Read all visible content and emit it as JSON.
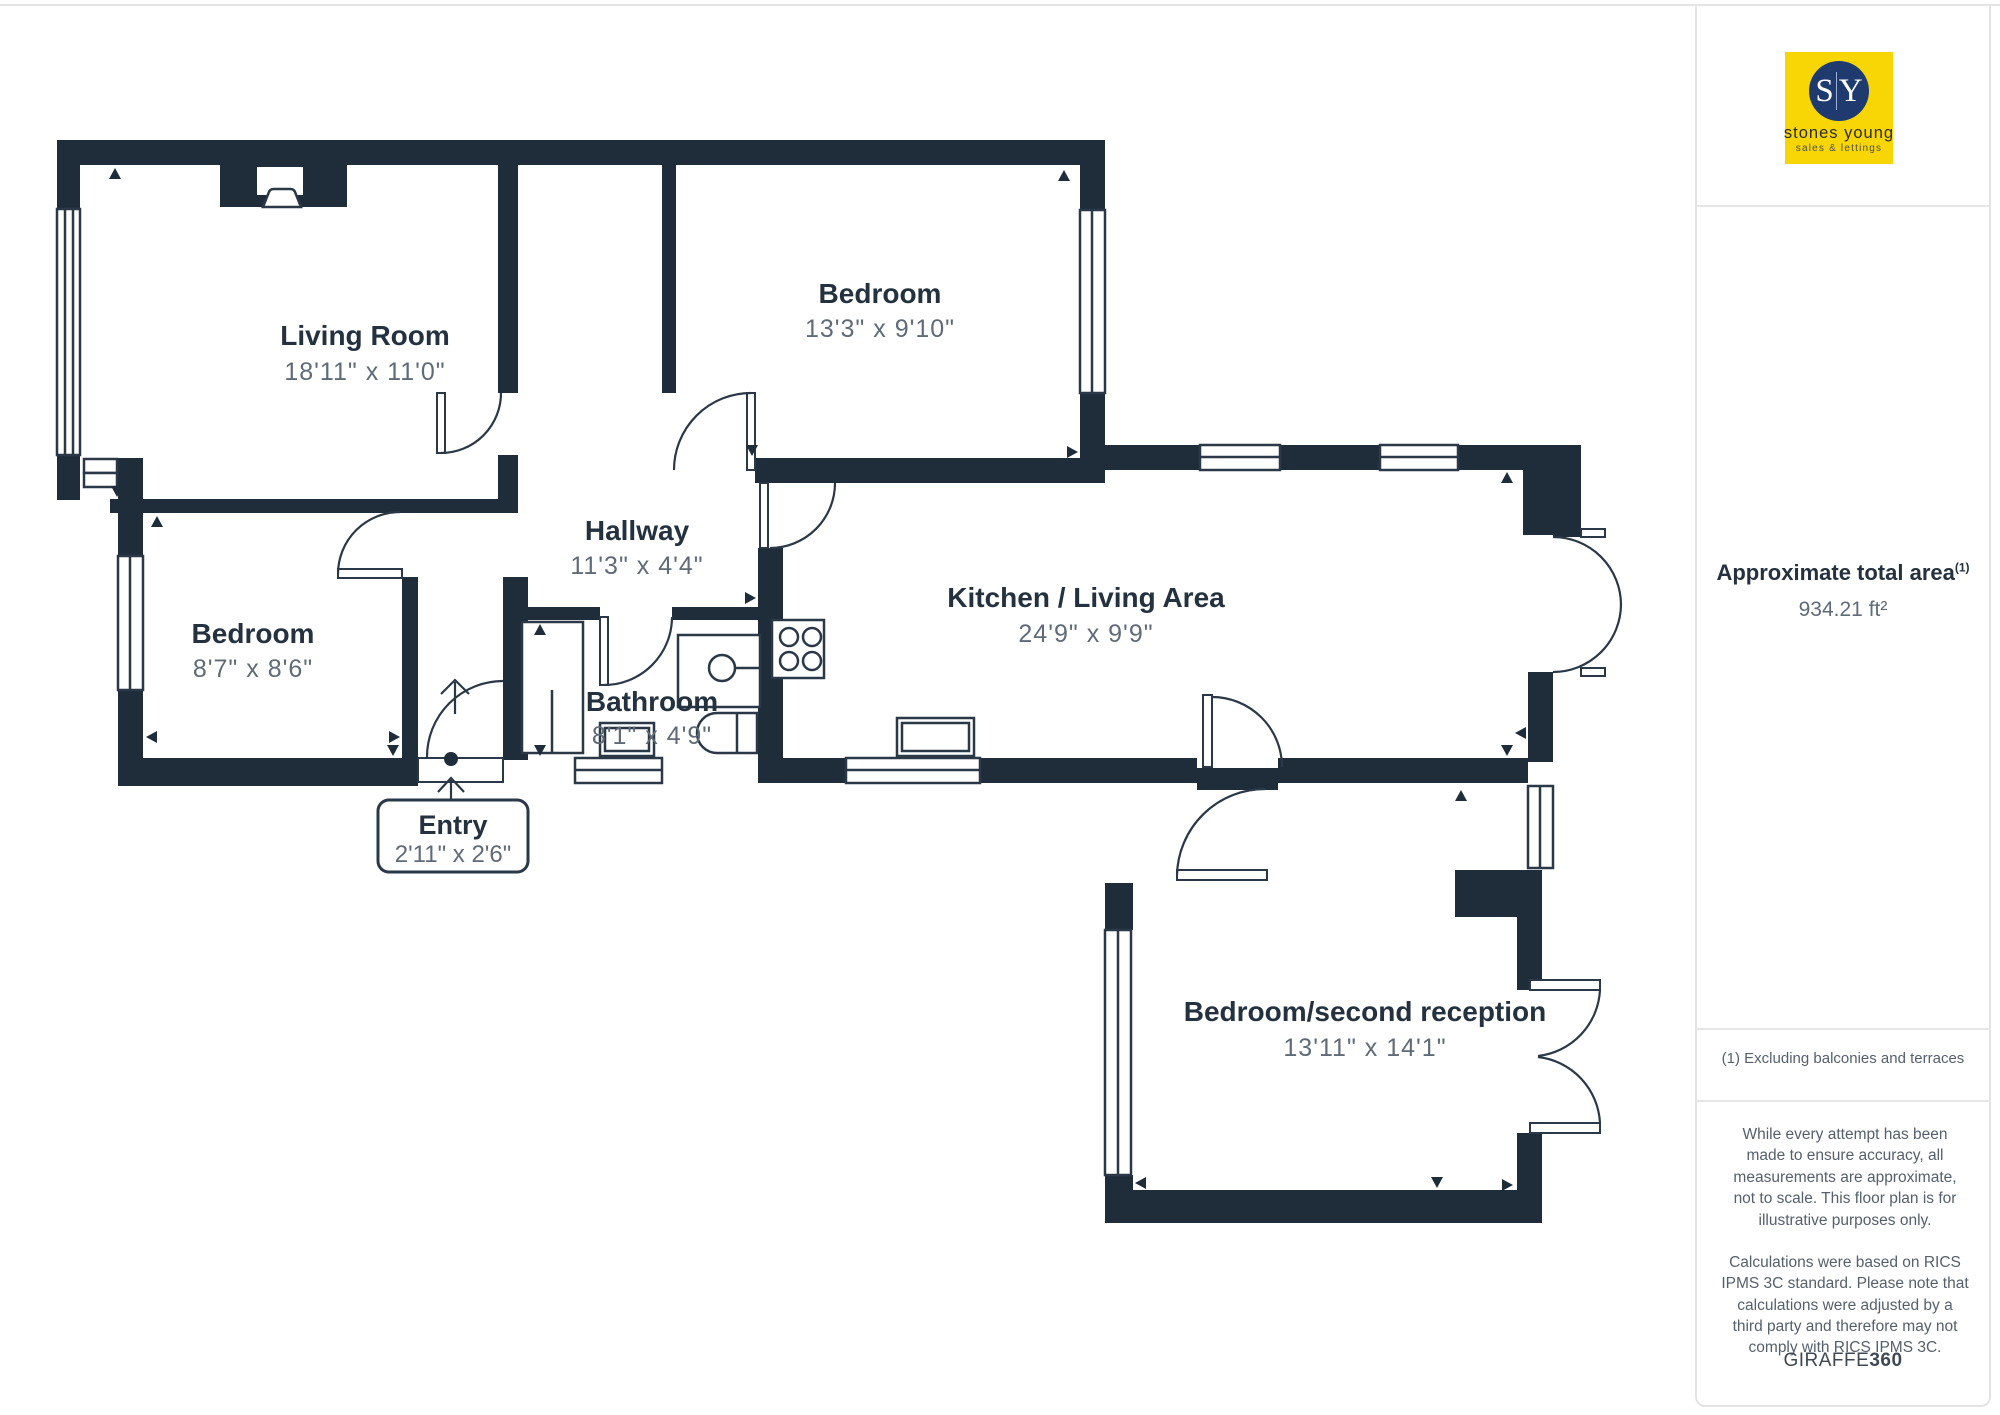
{
  "logo": {
    "monogram_left": "S",
    "monogram_right": "Y",
    "name": "stones young",
    "tagline": "sales & lettings",
    "bg_color": "#F8D606",
    "circle_color": "#1E3A6F"
  },
  "sidebar": {
    "area": {
      "title": "Approximate total area",
      "title_superscript": "(1)",
      "value": "934.21 ft²"
    },
    "footnote": "(1) Excluding balconies and terraces",
    "disclaimer_1": "While every attempt has been made to ensure accuracy, all measurements are approximate, not to scale. This floor plan is for illustrative purposes only.",
    "disclaimer_2": "Calculations were based on RICS IPMS 3C standard. Please note that calculations were adjusted by a third party and therefore may not comply with RICS IPMS 3C.",
    "brand": {
      "name": "GIRAFFE",
      "suffix": "360"
    }
  },
  "rooms": {
    "living_room": {
      "name": "Living Room",
      "dimensions": "18'11\" x 11'0\""
    },
    "bedroom_top": {
      "name": "Bedroom",
      "dimensions": "13'3\" x 9'10\""
    },
    "hallway": {
      "name": "Hallway",
      "dimensions": "11'3\" x 4'4\""
    },
    "bedroom_left": {
      "name": "Bedroom",
      "dimensions": "8'7\" x 8'6\""
    },
    "bathroom": {
      "name": "Bathroom",
      "dimensions": "8'1\" x 4'9\""
    },
    "kitchen": {
      "name": "Kitchen / Living Area",
      "dimensions": "24'9\" x 9'9\""
    },
    "entry": {
      "name": "Entry",
      "dimensions": "2'11\" x 2'6\""
    },
    "bedroom_second": {
      "name": "Bedroom/second reception",
      "dimensions": "13'11\" x 14'1\""
    }
  },
  "colors": {
    "wall": "#1F2D3B",
    "line": "#2A3847",
    "room_name": "#243240",
    "room_dim": "#5F6B77"
  }
}
